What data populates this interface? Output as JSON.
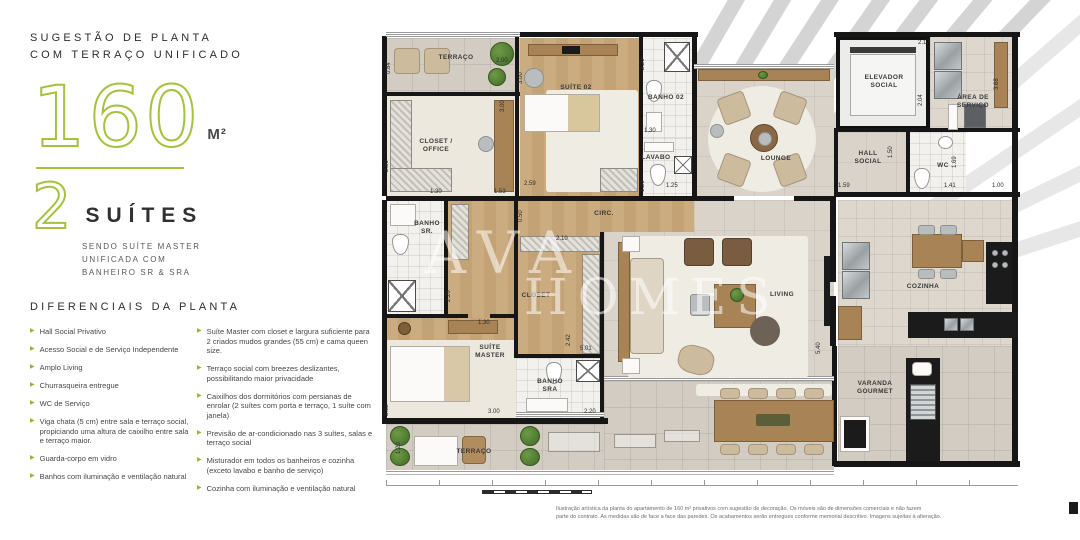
{
  "colors": {
    "accent_green": "#a4c23d",
    "arrow_green": "#8fb832",
    "wall_black": "#161616",
    "wood": "#c9ab80",
    "counter_black": "#1b1b1b"
  },
  "left_panel": {
    "header_line1": "SUGESTÃO DE PLANTA",
    "header_line2": "COM TERRAÇO UNIFICADO",
    "area_value": "160",
    "area_unit": "M²",
    "suites_value": "2",
    "suites_label": "SUÍTES",
    "suites_sub": [
      "SENDO SUÍTE MASTER",
      "UNIFICADA COM",
      "BANHEIRO SR & SRA"
    ],
    "diferenciais_title": "DIFERENCIAIS DA PLANTA",
    "diferenciais_left": [
      "Hall Social Privativo",
      "Acesso Social e de Serviço Independente",
      "Amplo Living",
      "Churrasqueira entregue",
      "WC de Serviço",
      "Viga chata (5 cm) entre sala e terraço social, propiciando uma altura de caixilho entre sala e terraço maior.",
      "Guarda-corpo em vidro",
      "Banhos com iluminação e ventilação natural"
    ],
    "diferenciais_right": [
      "Suíte Master com closet e largura suficiente para 2 criados mudos grandes (55 cm) e cama queen size.",
      "Terraço social com breezes deslizantes, possibilitando maior privacidade",
      "Caixilhos dos dormitórios com persianas de enrolar (2 suítes com porta e terraço, 1 suíte com janela)",
      "Previsão de ar-condicionado nas 3 suítes, salas e terraço social",
      "Misturador em todos os banheiros e cozinha (exceto lavabo e banho de serviço)",
      "Cozinha com iluminação e ventilação natural"
    ]
  },
  "watermark": {
    "line1": "AVA",
    "line2": "HOMES"
  },
  "plan": {
    "rooms": {
      "terraco_top": {
        "l1": "TERRAÇO"
      },
      "closet_office": {
        "l1": "CLOSET /",
        "l2": "OFFICE"
      },
      "suite02": {
        "l1": "SUÍTE 02"
      },
      "banho02": {
        "l1": "BANHO 02"
      },
      "lavabo": {
        "l1": "LAVABO"
      },
      "lounge": {
        "l1": "LOUNGE"
      },
      "elevador": {
        "l1": "ELEVADOR",
        "l2": "SOCIAL"
      },
      "area_servico": {
        "l1": "ÁREA DE",
        "l2": "SERVIÇO"
      },
      "hall": {
        "l1": "HALL",
        "l2": "SOCIAL"
      },
      "wc": {
        "l1": "WC"
      },
      "circ": {
        "l1": "CIRC."
      },
      "banho_sr": {
        "l1": "BANHO",
        "l2": "SR."
      },
      "closet": {
        "l1": "CLOSET"
      },
      "suite_master": {
        "l1": "SUÍTE",
        "l2": "MASTER"
      },
      "banho_sra": {
        "l1": "BANHO",
        "l2": "SRA"
      },
      "living": {
        "l1": "LIVING"
      },
      "cozinha": {
        "l1": "COZINHA"
      },
      "varanda": {
        "l1": "VARANDA",
        "l2": "GOURMET"
      },
      "terraco_bottom": {
        "l1": "TERRAÇO"
      }
    },
    "dimensions": [
      {
        "t": "0.84",
        "x": 14,
        "y": 40,
        "v": true
      },
      {
        "t": "2.00",
        "x": 118,
        "y": 30,
        "v": false
      },
      {
        "t": "3.00",
        "x": 128,
        "y": 78,
        "v": true
      },
      {
        "t": "2.50",
        "x": 12,
        "y": 138,
        "v": true
      },
      {
        "t": "1.30",
        "x": 52,
        "y": 161,
        "v": false
      },
      {
        "t": "1.53",
        "x": 116,
        "y": 161,
        "v": false
      },
      {
        "t": "0.50",
        "x": 146,
        "y": 188,
        "v": true
      },
      {
        "t": "2.59",
        "x": 146,
        "y": 153,
        "v": false
      },
      {
        "t": "3.00",
        "x": 146,
        "y": 50,
        "v": true
      },
      {
        "t": "2.20",
        "x": 268,
        "y": 36,
        "v": true
      },
      {
        "t": "1.30",
        "x": 266,
        "y": 100,
        "v": false
      },
      {
        "t": "1.20",
        "x": 268,
        "y": 158,
        "v": true
      },
      {
        "t": "1.25",
        "x": 288,
        "y": 155,
        "v": false
      },
      {
        "t": "2.17",
        "x": 540,
        "y": 12,
        "v": false
      },
      {
        "t": "2.04",
        "x": 546,
        "y": 72,
        "v": true
      },
      {
        "t": "3.68",
        "x": 622,
        "y": 56,
        "v": true
      },
      {
        "t": "1.50",
        "x": 516,
        "y": 124,
        "v": true
      },
      {
        "t": "1.59",
        "x": 460,
        "y": 155,
        "v": false
      },
      {
        "t": "1.69",
        "x": 580,
        "y": 134,
        "v": true
      },
      {
        "t": "1.41",
        "x": 566,
        "y": 155,
        "v": false
      },
      {
        "t": "1.00",
        "x": 614,
        "y": 155,
        "v": false
      },
      {
        "t": "2.26",
        "x": 74,
        "y": 268,
        "v": true
      },
      {
        "t": "2.10",
        "x": 178,
        "y": 208,
        "v": false
      },
      {
        "t": "2.42",
        "x": 194,
        "y": 312,
        "v": true
      },
      {
        "t": "5.01",
        "x": 202,
        "y": 318,
        "v": false
      },
      {
        "t": "3.02",
        "x": 12,
        "y": 382,
        "v": true
      },
      {
        "t": "1.30",
        "x": 100,
        "y": 292,
        "v": false
      },
      {
        "t": "3.00",
        "x": 110,
        "y": 381,
        "v": false
      },
      {
        "t": "2.20",
        "x": 206,
        "y": 381,
        "v": false
      },
      {
        "t": "5.40",
        "x": 444,
        "y": 320,
        "v": true
      },
      {
        "t": "1.20",
        "x": 24,
        "y": 420,
        "v": true
      }
    ],
    "disclaimer_line1": "Ilustração artística da planta do apartamento de 160 m² privativos com sugestão de decoração. Os móveis são de dimensões comerciais e não fazem",
    "disclaimer_line2": "parte do contrato. As medidas são de face a face das paredes. Os acabamentos serão entregues conforme memorial descritivo. Imagens sujeitas à alteração."
  }
}
